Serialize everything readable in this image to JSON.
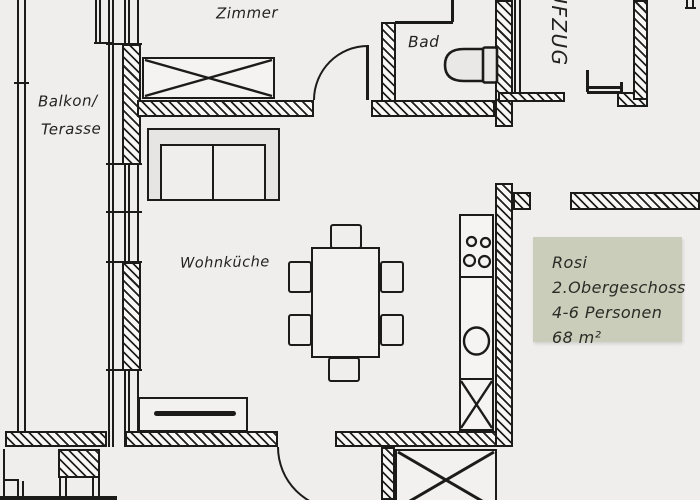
{
  "rooms": {
    "zimmer": "Zimmer",
    "bad": "Bad",
    "aufzug": "AUFZUG",
    "balkon_line1": "Balkon/",
    "balkon_line2": "Terasse",
    "wohnkueche": "Wohnküche"
  },
  "info_box": {
    "line1": "Rosi",
    "line2": "2.Obergeschoss",
    "line3": "4-6 Personen",
    "line4": "68 m²",
    "bg_color": "#c9cdba"
  },
  "colors": {
    "background": "#efeeec",
    "line": "#1b1b19",
    "info_box_bg": "#c9cdba"
  }
}
